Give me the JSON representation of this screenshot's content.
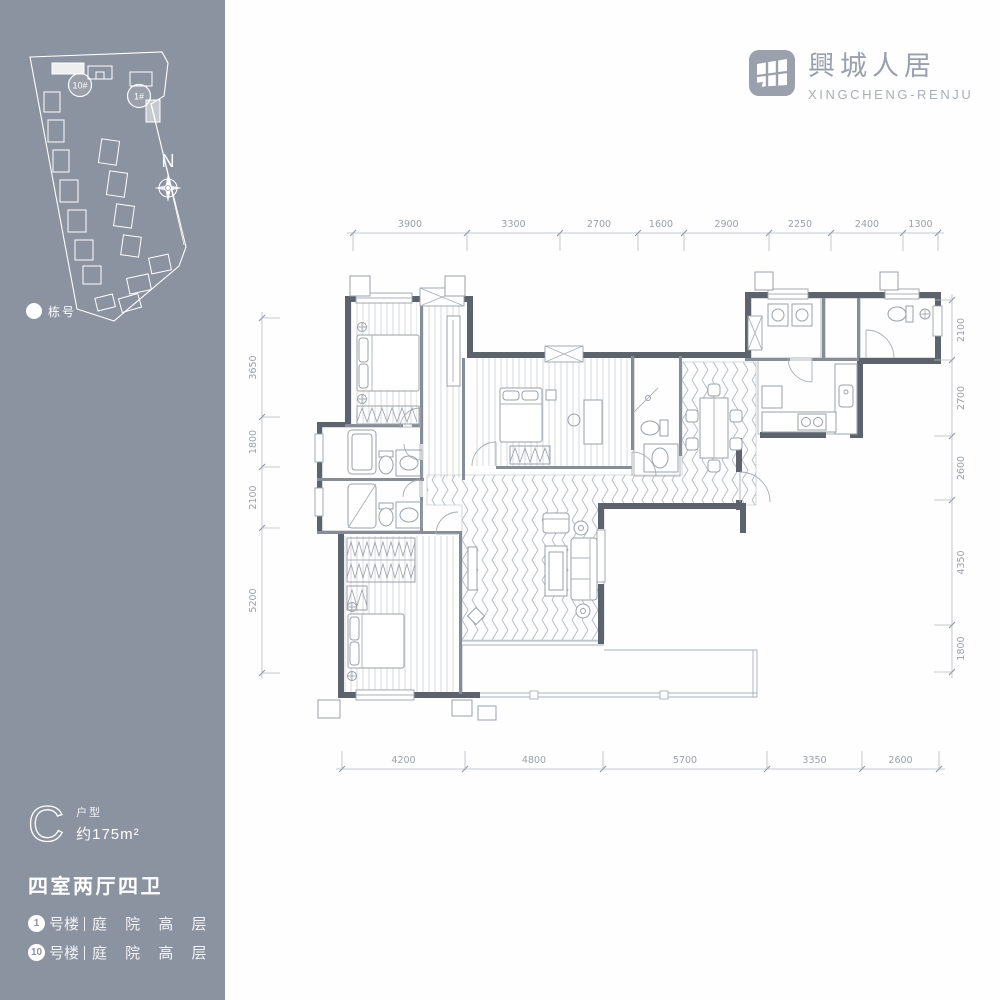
{
  "colors": {
    "sidebar_bg": "#8b92a0",
    "wall": "#5d636d",
    "partition": "#878d97",
    "line_light": "#9aa1aa",
    "dim_text": "#9ba0a9",
    "white": "#ffffff"
  },
  "header": {
    "logo_title": "興城人居",
    "logo_subtitle": "XINGCHENG-RENJU"
  },
  "siteplan": {
    "building_10": "10#",
    "building_1": "1#",
    "north": "N",
    "legend": "栋号"
  },
  "unit_info": {
    "letter": "C",
    "type_label": "户型",
    "area": "约175m²",
    "rooms": "四室两厅四卫",
    "buildings": [
      {
        "badge": "1",
        "name": "号楼",
        "detail": "庭 院 高 层"
      },
      {
        "badge": "10",
        "name": "号楼",
        "detail": "庭 院 高 层"
      }
    ]
  },
  "floorplan": {
    "dims_top": [
      "3900",
      "3300",
      "2700",
      "1600",
      "2900",
      "2250",
      "2400",
      "1300"
    ],
    "dims_bottom": [
      "4200",
      "4800",
      "5700",
      "3350",
      "2600"
    ],
    "dims_left": [
      "3650",
      "1800",
      "2100",
      "5200"
    ],
    "dims_right": [
      "2100",
      "2700",
      "2600",
      "4350",
      "1800"
    ]
  }
}
